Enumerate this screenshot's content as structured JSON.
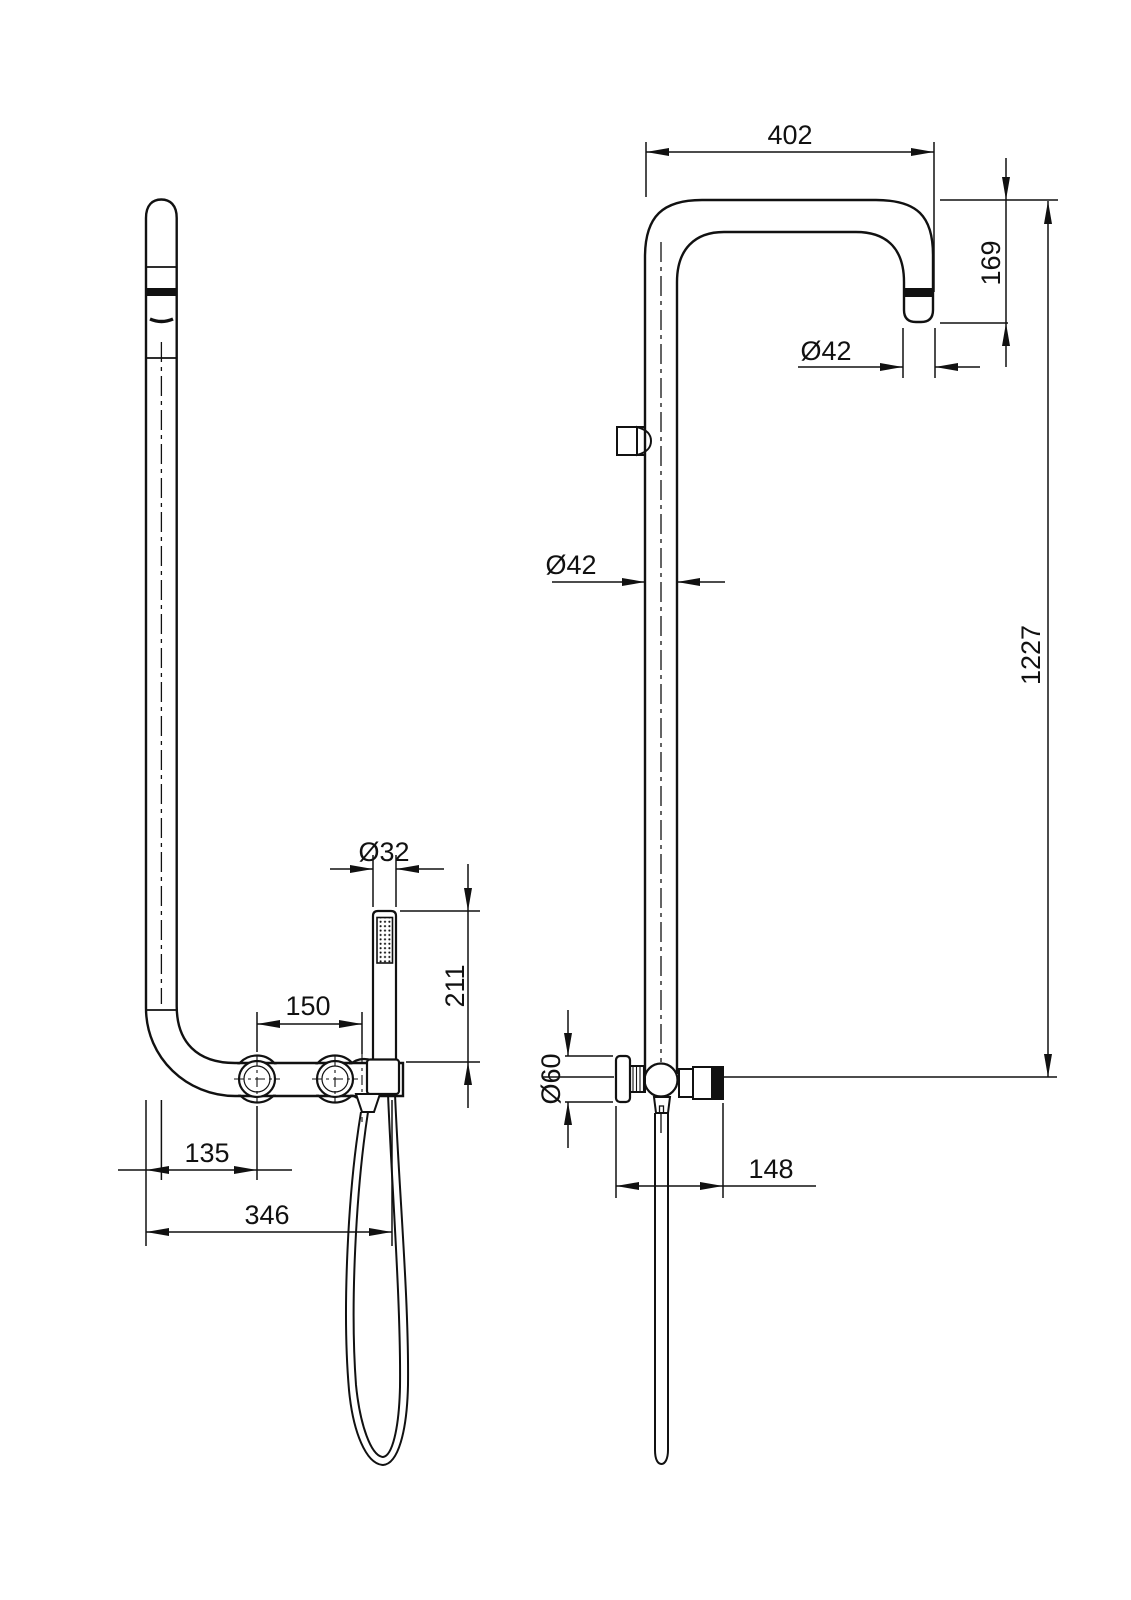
{
  "drawing": {
    "background": "#ffffff",
    "line_color": "#111111",
    "type": "shower-column-dimensional-drawing"
  },
  "dims": {
    "arm_width": "402",
    "arm_drop": "169",
    "spout_diameter": "Ø42",
    "riser_diameter": "Ø42",
    "total_height": "1227",
    "handshower_diameter": "Ø32",
    "handshower_length": "211",
    "handle_spacing": "150",
    "wall_to_handle": "135",
    "wall_to_holder": "346",
    "knob_diameter": "Ø60",
    "valve_depth": "148"
  }
}
